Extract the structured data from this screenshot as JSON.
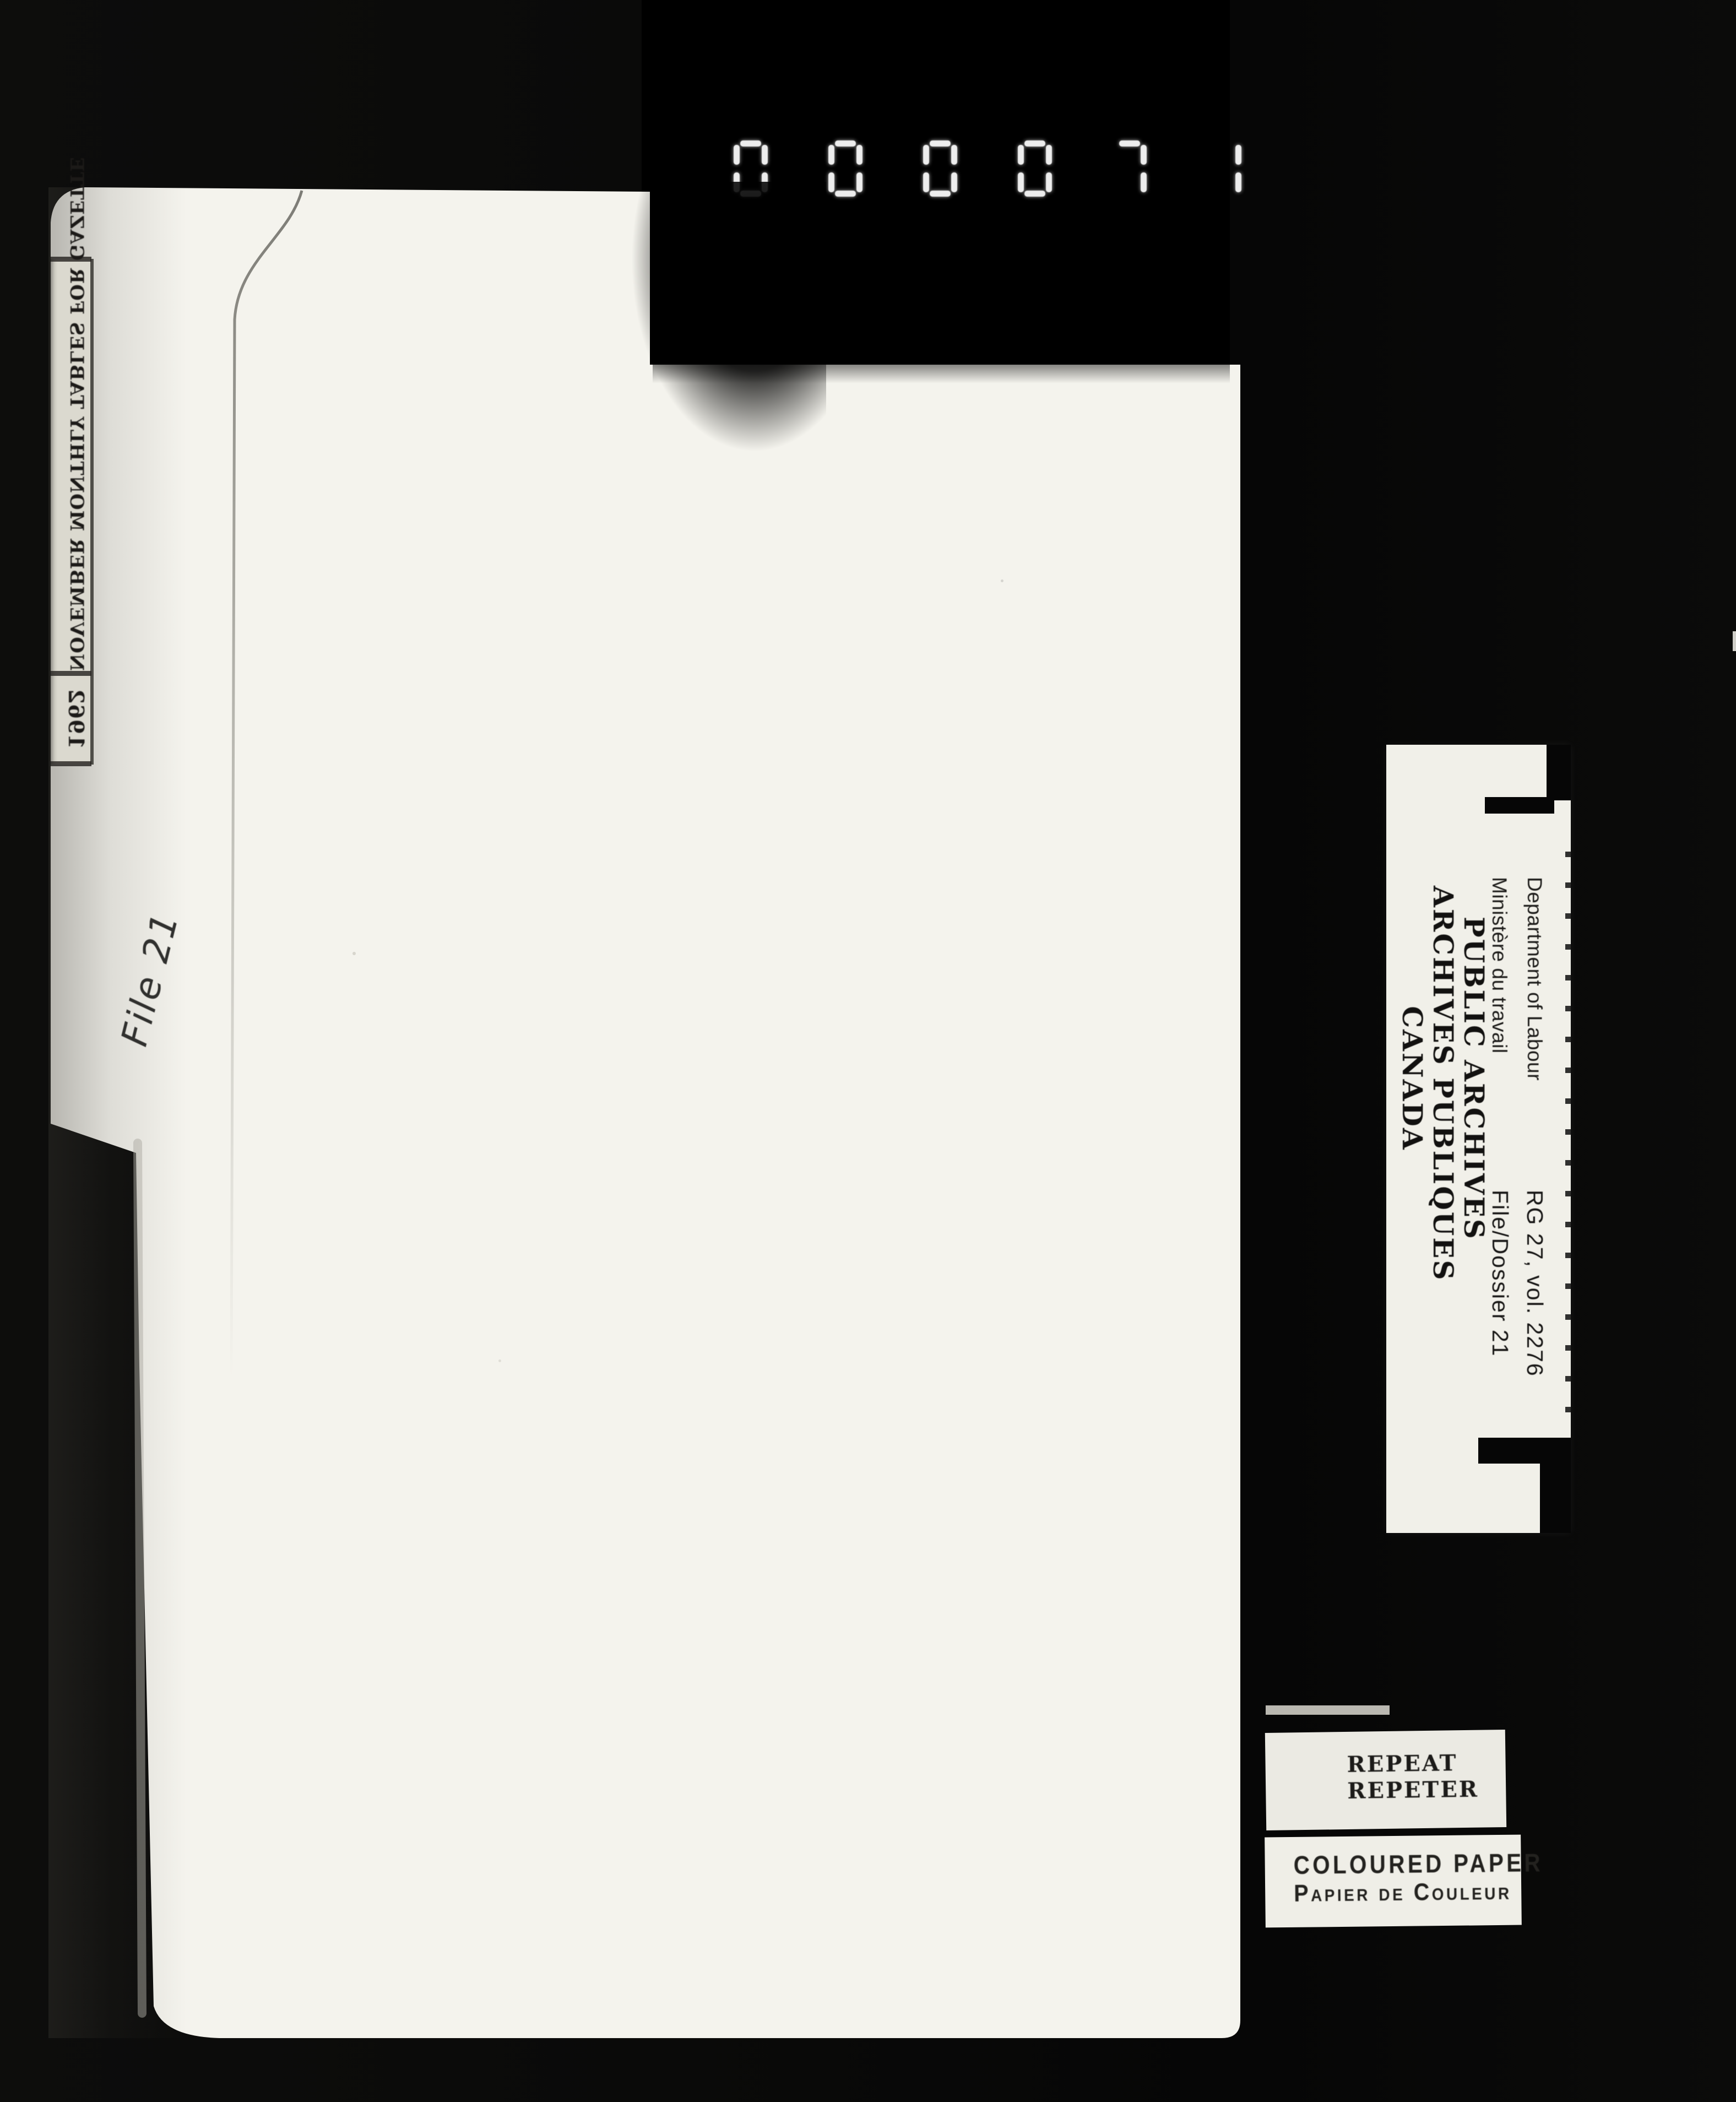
{
  "counter": {
    "value": "000071",
    "digit_color": "#ededed",
    "style": "seven-segment"
  },
  "folder": {
    "tab_label": {
      "year": "1962",
      "title": "NOVEMBER MONTHLY TABLES FOR GAZETTE",
      "note": "stamped text appears mirrored and rotated on the scan"
    },
    "handwritten_note": "File 21"
  },
  "archives_card": {
    "institution": {
      "line1": "PUBLIC ARCHIVES",
      "line2": "ARCHIVES PUBLIQUES",
      "line3": "CANADA"
    },
    "department": {
      "line1": "Department of Labour",
      "line2": "Ministère du travail"
    },
    "reference": {
      "line1": "RG 27, vol. 2276",
      "line2": "File/Dossier 21"
    }
  },
  "stamps": {
    "repeat": {
      "line1": "REPEAT",
      "line2": "REPETER"
    },
    "coloured_paper": {
      "line1": "COLOURED PAPER",
      "line2": "Papier de Couleur"
    }
  },
  "colors": {
    "background": "#0a0a09",
    "printed_black_area": "#000000",
    "folder_paper": "#f4f3ed",
    "card_paper": "#f1f0e9",
    "tab_label_paper": "#dbd9cf",
    "stamp_ink": "#1c1b19",
    "counter_segments": "#ededed"
  }
}
